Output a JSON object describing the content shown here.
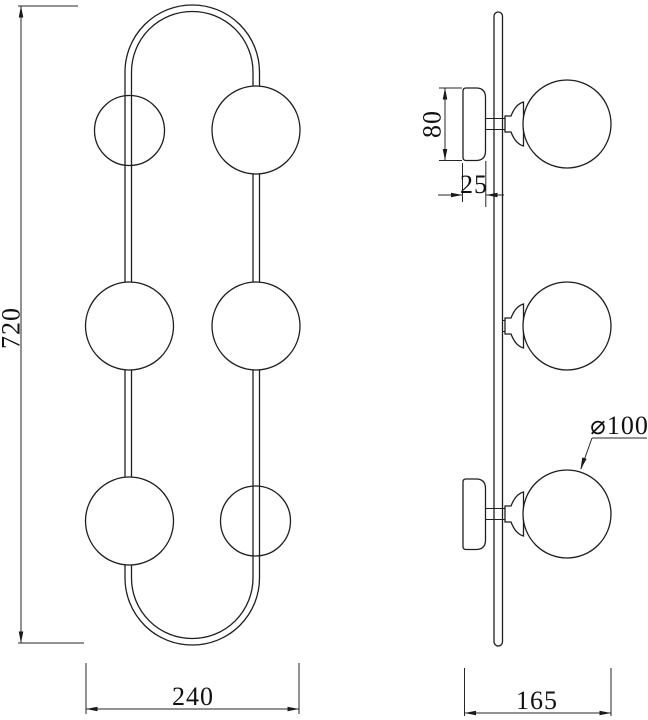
{
  "drawing": {
    "kind": "technical-drawing",
    "dims": {
      "overall_height": "720",
      "overall_width": "240",
      "canopy_height": "80",
      "canopy_depth": "25",
      "shade_diameter": "⌀100",
      "overall_depth": "165"
    },
    "colors": {
      "line": "#1f1f1f",
      "dimension_line": "#262626",
      "text": "#111111",
      "background": "#ffffff"
    }
  }
}
